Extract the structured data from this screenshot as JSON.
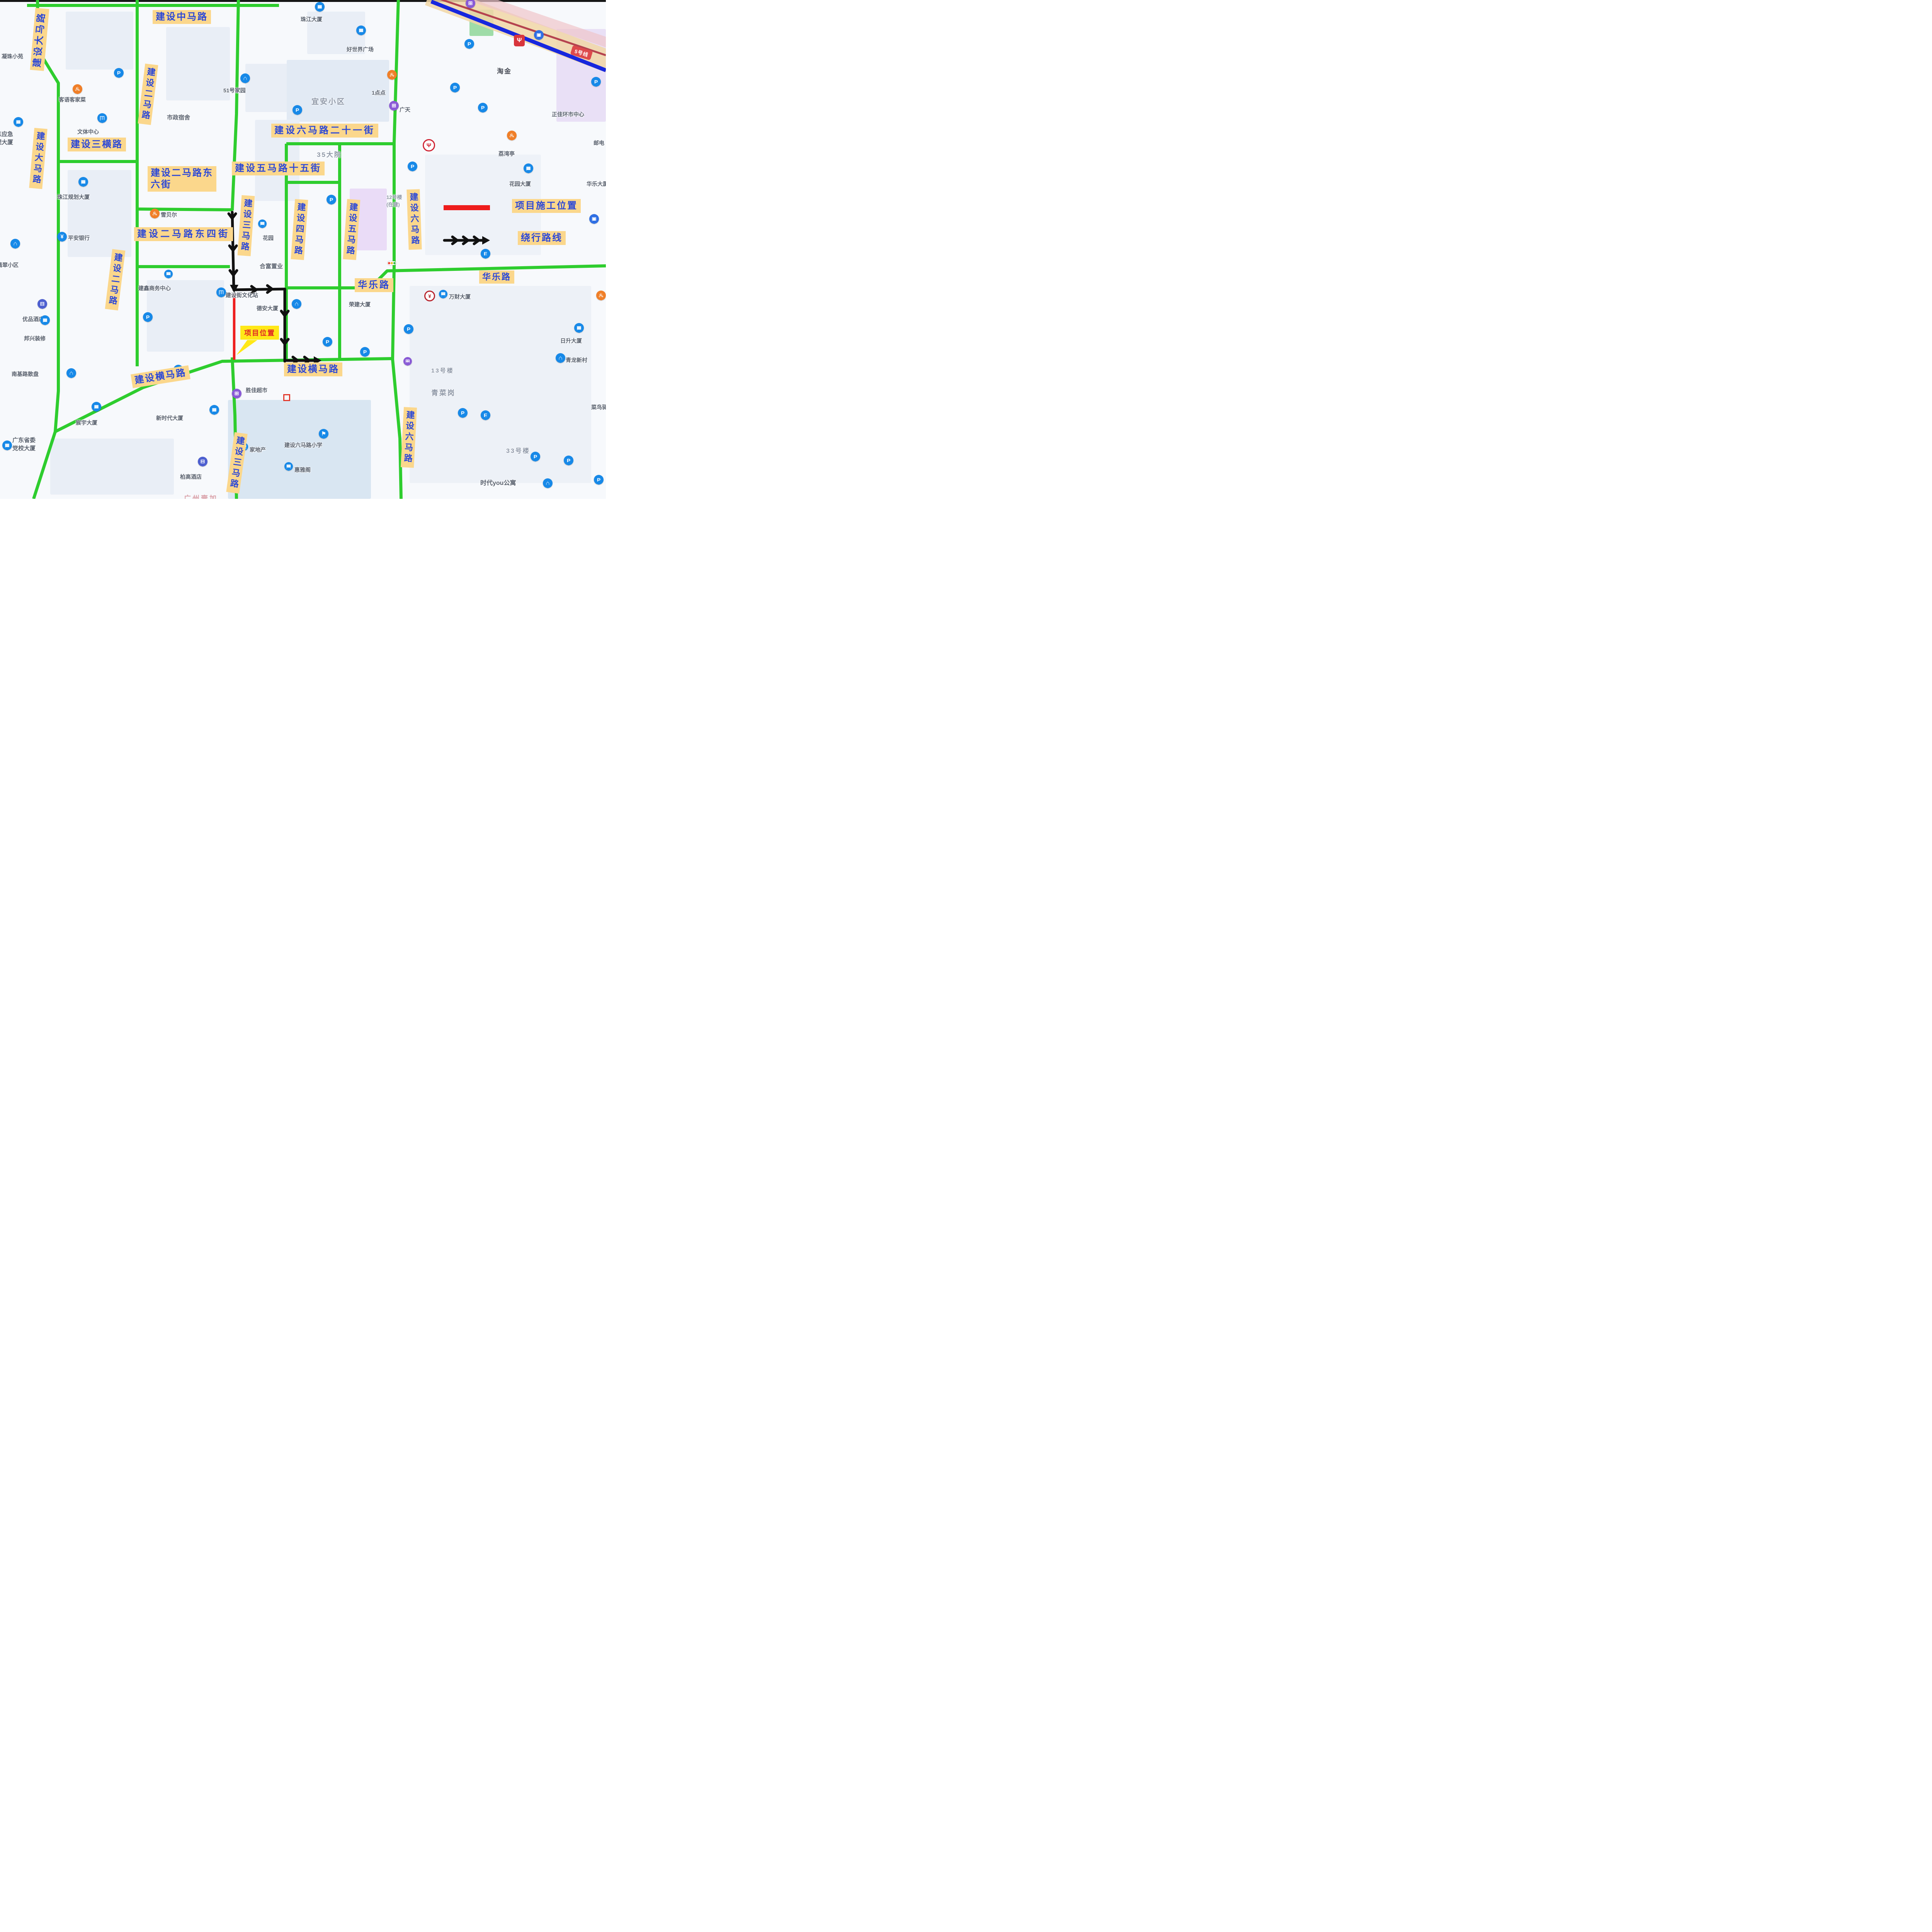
{
  "legend": {
    "construction_label": "项目施工位置",
    "detour_label": "绕行路线",
    "project_callout": "项目位置"
  },
  "transit": {
    "line_badge": "5号线",
    "station_name": "淘金"
  },
  "road_labels": {
    "zhongma": "建设中马路",
    "dama_top": "建设大马路",
    "erma_top": "建设二马路",
    "dama_left": "建设大马路",
    "sanhen": "建设三横路",
    "dong6_l1": "建设二马路东",
    "dong6_l2": "六街",
    "dong4": "建设二马路东四街",
    "liuma21": "建设六马路二十一街",
    "wuma15": "建设五马路十五街",
    "erma_left": "建设二马路",
    "sanma_mid": "建设三马路",
    "sima": "建设四马路",
    "wuma": "建设五马路",
    "liuma_right": "建设六马路",
    "huale_left": "华乐路",
    "huale_right": "华乐路",
    "hengma_left": "建设横马路",
    "hengma_center": "建设横马路",
    "sanma_bottom": "建设三马路",
    "liuma_bottom": "建设六马路"
  },
  "pois": {
    "ningzhu": "凝珠小苑",
    "zhujiang": "珠江大厦",
    "haoshijie": "好世界广场",
    "yidiandian": "1点点",
    "guangtian": "广天",
    "zhengjia": "正佳环市中心",
    "liwanting": "荔湾亭",
    "youdian": "邮电",
    "huayuandasha": "花园大厦",
    "hualedasha": "华乐大厦",
    "yian": "宜安小区",
    "no51": "51号家园",
    "shizheng": "市政宿舍",
    "keyu": "客语客家菜",
    "wenti": "文体中心",
    "yingji_l1": "广东应急",
    "yingji_l2": "管理大厦",
    "zhujiangguihua": "珠江规划大厦",
    "feicui": "翡翠小区",
    "pingan": "平安银行",
    "youpin": "优品酒店",
    "bangxing": "邦兴装修",
    "nanji": "南基路散盘",
    "dangxiao_l1": "广东省委",
    "dangxiao_l2": "党校大厦",
    "chenyu": "宸宇大厦",
    "xinshidai": "新时代大厦",
    "baigao": "柏高酒店",
    "guangzhouyi": "广州壹加",
    "shengjia": "胜佳超市",
    "liumaxiaoxue": "建设六马路小学",
    "jiadichan": "家地产",
    "huiyage": "惠雅阁",
    "xuebeier": "雪贝尔",
    "dayuan35": "35大院",
    "hefu": "合富置业",
    "huayuan": "花园",
    "wenhuazhan": "建设街文化站",
    "dean": "德安大厦",
    "jianxin": "建鑫商务中心",
    "no12_l1": "12号楼",
    "no12_l2": "(在建)",
    "wancai": "万财大厦",
    "rongjian": "荣建大厦",
    "no13": "13号楼",
    "qingcaigang": "青菜岗",
    "risheng": "日升大厦",
    "qinglong": "青龙新村",
    "cainiao": "菜鸟驿站",
    "no33": "33号楼",
    "shidai": "时代you公寓"
  },
  "colors": {
    "open_road": "#2ecd2e",
    "closed_road": "#ee1f1f",
    "detour": "#111111",
    "label_bg": "#fbd78c",
    "label_text": "#2946d8",
    "metro_line": "#1727de"
  }
}
